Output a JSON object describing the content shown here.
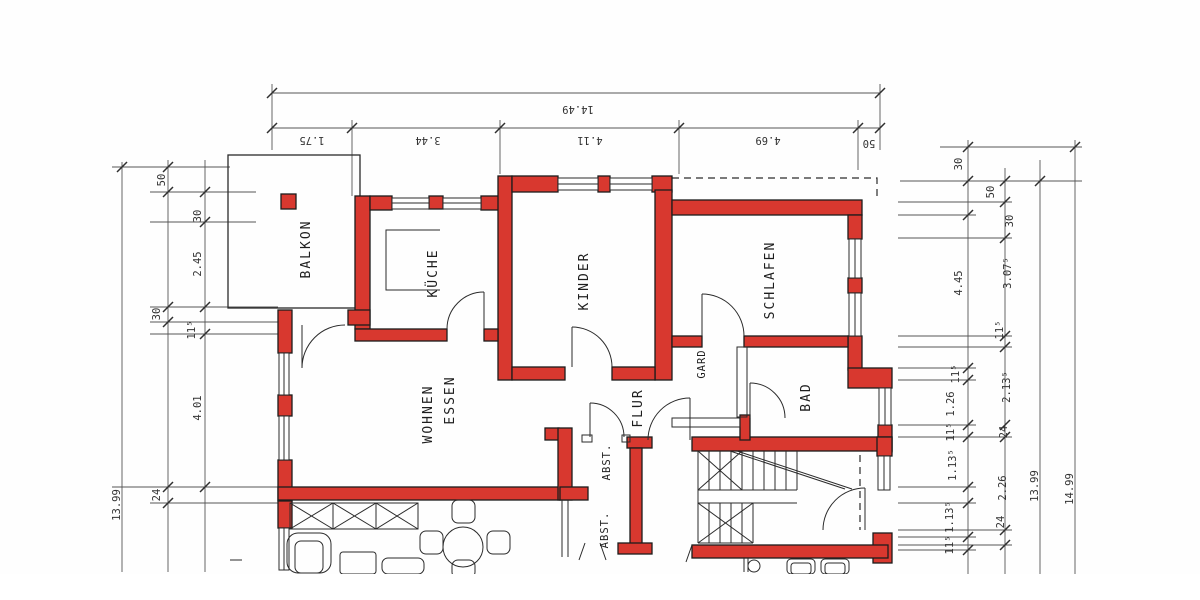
{
  "meta": {
    "type": "floor-plan",
    "language": "de",
    "style": "scanned architectural drawing"
  },
  "colors": {
    "wall_red": "#d8382f",
    "line": "#2b2b2b",
    "paper": "#ffffff"
  },
  "rooms": {
    "balkon": "BALKON",
    "kueche": "KÜCHE",
    "kinder": "KINDER",
    "schlafen": "SCHLAFEN",
    "wohnen": "WOHNEN",
    "essen": "ESSEN",
    "flur": "FLUR",
    "gard": "GARD",
    "bad": "BAD",
    "abst1": "ABST.",
    "abst2": "ABST."
  },
  "dims": {
    "top": {
      "overall": "14.49",
      "segments": [
        "1.75",
        "3.44",
        "4.11",
        "4.69",
        "50"
      ]
    },
    "left": {
      "overall": "13.99",
      "segments": [
        "50",
        "30",
        "2.45",
        "30",
        "11⁵",
        "4.01",
        "24"
      ]
    },
    "right": {
      "inner": [
        "30",
        "4.45",
        "11⁵",
        "1.26",
        "11⁵",
        "1.13⁵",
        "1.13⁵",
        "11⁵"
      ],
      "mid": [
        "50",
        "30",
        "3.07⁵",
        "11⁵",
        "2.13⁵",
        "24",
        "2.26",
        "24"
      ],
      "total_inner": "13.99",
      "total_outer": "14.99"
    }
  }
}
